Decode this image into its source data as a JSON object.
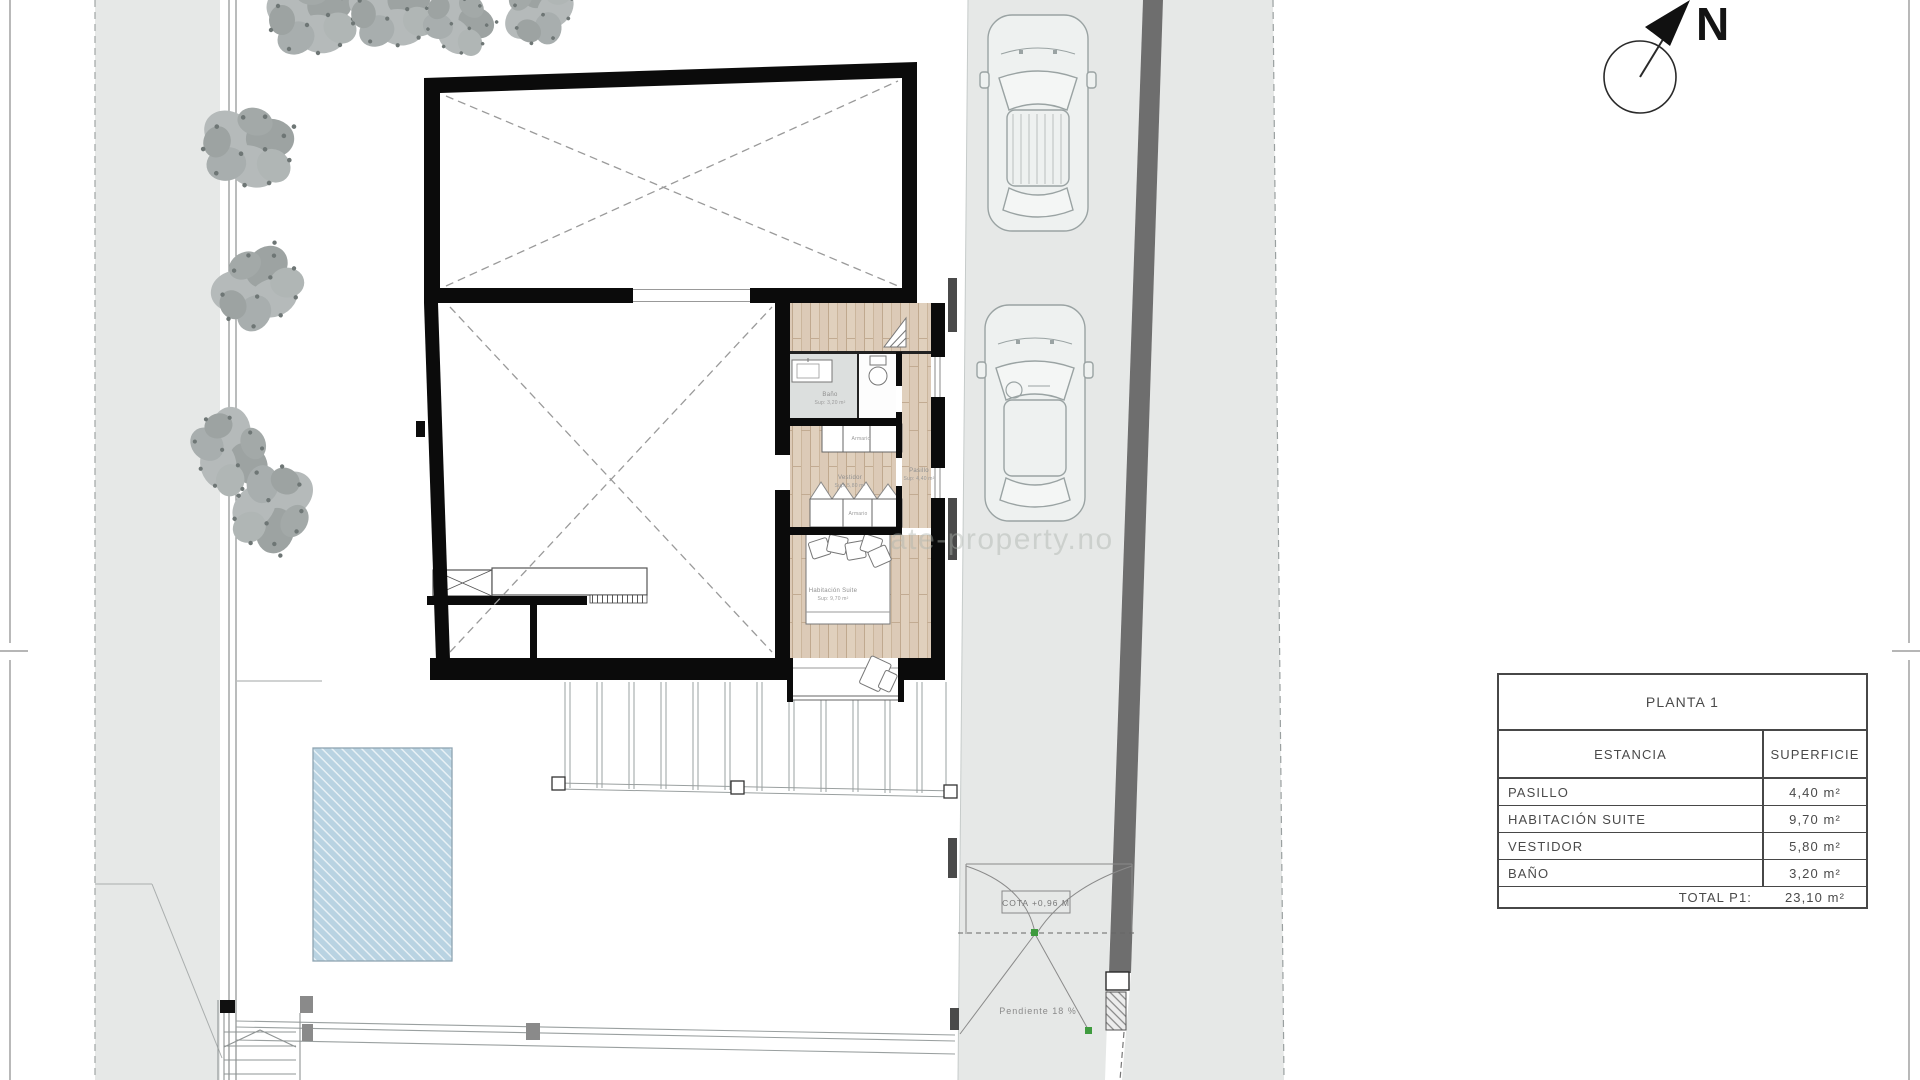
{
  "title_block": {
    "title": "PLANTA 1",
    "columns": {
      "room": "ESTANCIA",
      "area": "SUPERFICIE"
    },
    "rows": [
      {
        "room": "PASILLO",
        "area": "4,40 m²"
      },
      {
        "room": "HABITACIÓN SUITE",
        "area": "9,70 m²"
      },
      {
        "room": "VESTIDOR",
        "area": "5,80 m²"
      },
      {
        "room": "BAÑO",
        "area": "3,20 m²"
      }
    ],
    "total_label": "TOTAL P1:",
    "total_value": "23,10 m²"
  },
  "plan_labels": {
    "bano_name": "Baño",
    "bano_area": "Sup: 3,20 m²",
    "armario_top": "Armario",
    "armario_bottom": "Armario",
    "vestidor_name": "Vestidor",
    "vestidor_area": "Sup: 5,80 m²",
    "pasillo_name": "Pasillo",
    "pasillo_area": "Sup: 4,40 m²",
    "suite_name": "Habitación Suite",
    "suite_area": "Sup: 9,70 m²",
    "gate_cota": "COTA +0,96 M",
    "slope": "Pendiente 18 %"
  },
  "compass": {
    "north_label": "N"
  },
  "watermark": "ate-property.no",
  "colors": {
    "site_gray": "#e6e8e7",
    "boundary_wall_gray": "#6e6e6e",
    "wood_floor": "#dccab7",
    "bath_floor_gray": "#dcdfde",
    "pool_blue": "#b9d3e2",
    "wall_black": "#0b0b0b",
    "marker_green": "#3f9b3f"
  }
}
